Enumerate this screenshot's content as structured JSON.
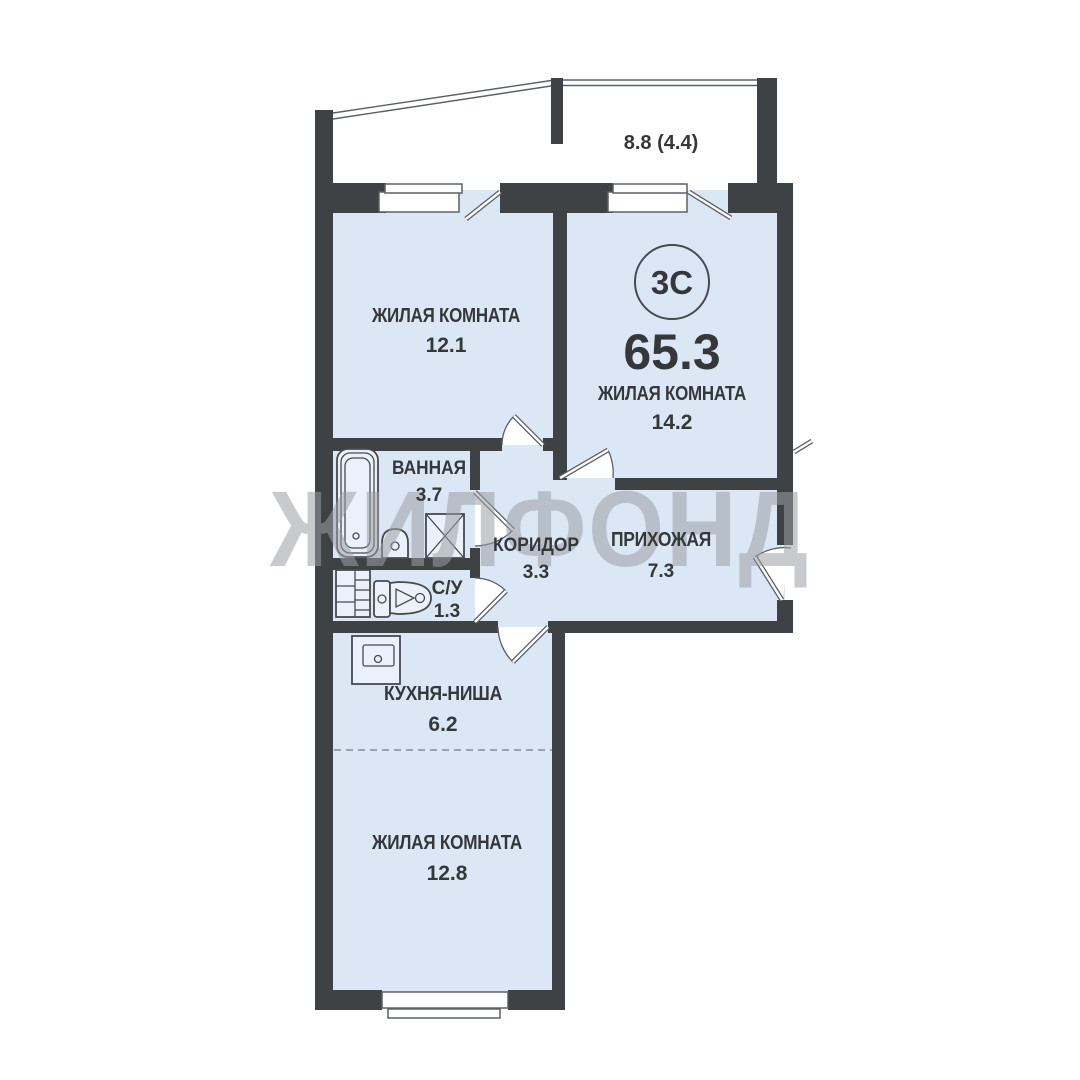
{
  "plan": {
    "watermark": "ЖИЛФОНД",
    "badge": "3С",
    "total_area": "65.3",
    "balcony_label": "8.8 (4.4)",
    "rooms": {
      "living1": {
        "name": "ЖИЛАЯ КОМНАТА",
        "area": "12.1"
      },
      "living2": {
        "name": "ЖИЛАЯ КОМНАТА",
        "area": "14.2"
      },
      "bathroom": {
        "name": "ВАННАЯ",
        "area": "3.7"
      },
      "corridor": {
        "name": "КОРИДОР",
        "area": "3.3"
      },
      "hallway": {
        "name": "ПРИХОЖАЯ",
        "area": "7.3"
      },
      "wc": {
        "name": "С/У",
        "area": "1.3"
      },
      "kitchen": {
        "name": "КУХНЯ-НИША",
        "area": "6.2"
      },
      "living3": {
        "name": "ЖИЛАЯ КОМНАТА",
        "area": "12.8"
      }
    },
    "colors": {
      "wall": "#3e4245",
      "floor": "#dce7f6",
      "fixture_fill": "#eaf1fa",
      "outline": "#5b6065",
      "text": "#35383b",
      "watermark": "#9b9fa4"
    }
  }
}
